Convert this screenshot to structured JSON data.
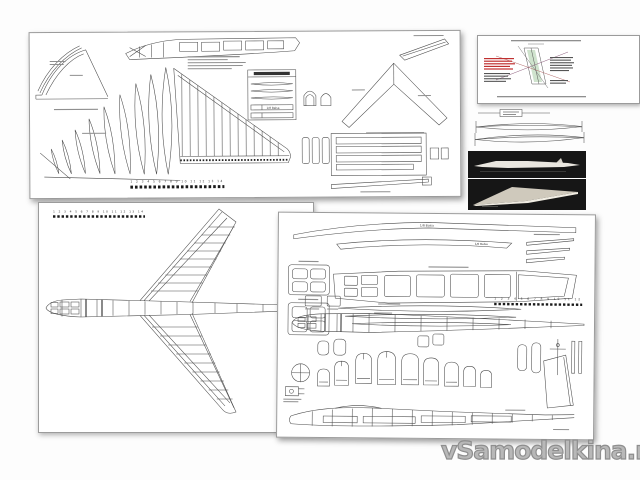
{
  "watermark": {
    "text": "vSamodelkina.ru",
    "color": "#9c9c9c"
  },
  "labels": {
    "balsa": "1/8 Balsa"
  },
  "rulers": {
    "top_sheet": "1 2 3 4 5 6 7 8 9 10 11 12 13 14",
    "plan_sheet": "1 2 3 4 5 6 7 8 9 10 11 12 13 14",
    "parts_sheet": "1 2 3 4 5 6 7 8 9 10 11 12"
  },
  "colors": {
    "ink": "#4a4a4a",
    "paper": "#ffffff",
    "photo_background": "#161616",
    "photo_fuselage": "#e9e6df",
    "photo_wing": "#cfc9bc",
    "card_red": "#c03030",
    "card_green": "#cfe3cd",
    "card_purple": "#8a5a7a"
  }
}
